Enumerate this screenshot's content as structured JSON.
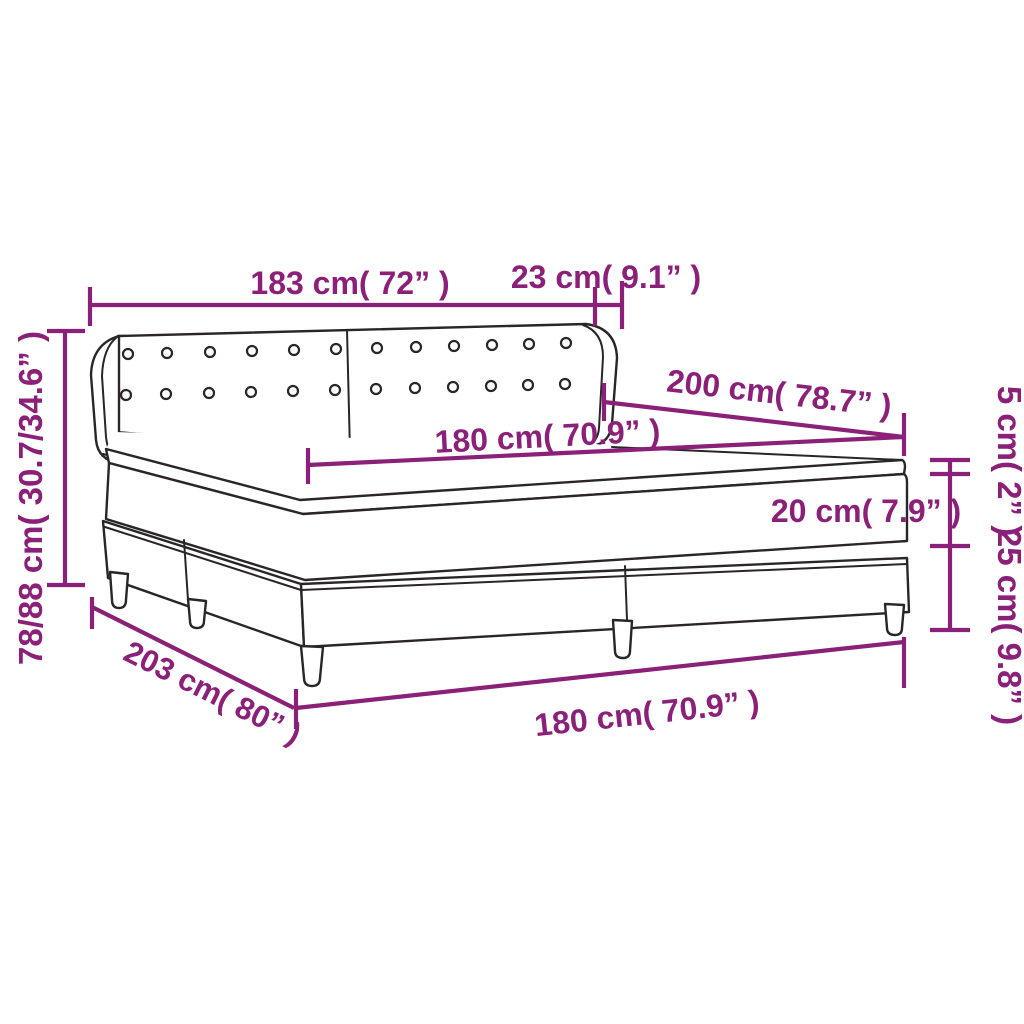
{
  "diagram": {
    "colors": {
      "dimension_line": "#8B2078",
      "outline": "#2A2627",
      "background": "#FFFFFF"
    },
    "measurements": {
      "headboard_width": "183 cm( 72” )",
      "headboard_wing_depth": "23 cm( 9.1” )",
      "total_height": "78/88 cm( 30.7/34.6” )",
      "bed_length": "200 cm( 78.7” )",
      "mattress_width_top": "180 cm( 70.9” )",
      "topper_height": "5 cm( 2” )",
      "mattress_height": "20 cm( 7.9” )",
      "base_height_with_legs": "25 cm( 9.8” )",
      "base_length": "203 cm( 80” )",
      "base_width_bottom": "180 cm( 70.9” )"
    }
  }
}
